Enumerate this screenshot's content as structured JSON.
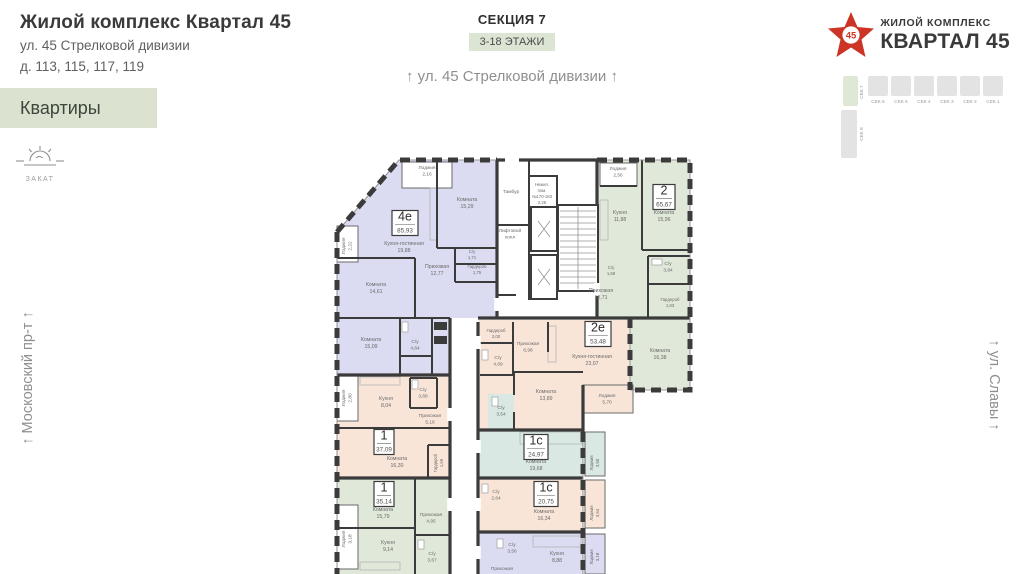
{
  "brand": {
    "title": "Жилой комплекс Квартал 45",
    "address_line1": "ул. 45 Стрелковой дивизии",
    "address_line2": "д. 113, 115, 117, 119"
  },
  "nav": {
    "flats_tab": "Квартиры"
  },
  "sunset": {
    "label": "ЗАКАТ"
  },
  "section_header": {
    "title": "СЕКЦИЯ 7",
    "floors_badge": "3-18 ЭТАЖИ",
    "street_top": "↑ ул. 45 Стрелковой дивизии ↑"
  },
  "streets": {
    "left": "↑ Московский пр-т ↑",
    "right": "↑ ул. Славы ↑"
  },
  "logo": {
    "star_number": "45",
    "line1": "ЖИЛОЙ КОМПЛЕКС",
    "line2": "КВАРТАЛ 45"
  },
  "minimap": {
    "sections_row": [
      "СЕК 6",
      "СЕК 5",
      "СЕК 4",
      "СЕК 3",
      "СЕК 2",
      "СЕК 1"
    ],
    "section_left_top": "СЕК 7",
    "section_left_bottom": "СЕК 8"
  },
  "colors": {
    "accent_green": "#dbe3d0",
    "apartment_lavender": "#dbdcf1",
    "apartment_green": "#e0e8da",
    "apartment_peach": "#f8e5d8",
    "apartment_teal": "#d9e8e3",
    "wall": "#3b3b3b",
    "logo_red": "#cc3526"
  },
  "plan": {
    "apartments": [
      {
        "type": "4е",
        "area": "85,93",
        "x": 405,
        "y": 223,
        "w": 26
      },
      {
        "type": "2",
        "area": "65,67",
        "x": 664,
        "y": 197,
        "w": 22
      },
      {
        "type": "2е",
        "area": "53,48",
        "x": 598,
        "y": 334,
        "w": 26
      },
      {
        "type": "1",
        "area": "37,09",
        "x": 384,
        "y": 442,
        "w": 20
      },
      {
        "type": "1",
        "area": "35,14",
        "x": 384,
        "y": 494,
        "w": 20
      },
      {
        "type": "1с",
        "area": "24,97",
        "x": 536,
        "y": 447,
        "w": 24
      },
      {
        "type": "1с",
        "area": "20,75",
        "x": 546,
        "y": 494,
        "w": 24
      }
    ],
    "labels": [
      {
        "lines": [
          "Лоджия",
          "2,16"
        ],
        "x": 427,
        "y": 169,
        "fs": 4.8
      },
      {
        "lines": [
          "Лоджия",
          "2,22"
        ],
        "x": 345,
        "y": 246,
        "rot": -90,
        "fs": 4.8
      },
      {
        "lines": [
          "Комната",
          "15,29"
        ],
        "x": 467,
        "y": 201
      },
      {
        "lines": [
          "Кухня-гостинная",
          "19,88"
        ],
        "x": 404,
        "y": 245
      },
      {
        "lines": [
          "Прихожая",
          "12,77"
        ],
        "x": 437,
        "y": 268
      },
      {
        "lines": [
          "С/у",
          "1,71"
        ],
        "x": 472,
        "y": 253,
        "fs": 4.3
      },
      {
        "lines": [
          "Гардероб",
          "1,75"
        ],
        "x": 477,
        "y": 268,
        "fs": 4.3
      },
      {
        "lines": [
          "Комната",
          "14,61"
        ],
        "x": 376,
        "y": 286
      },
      {
        "lines": [
          "Комната",
          "15,09"
        ],
        "x": 371,
        "y": 341
      },
      {
        "lines": [
          "С/у",
          "4,64"
        ],
        "x": 415,
        "y": 343,
        "fs": 4.8
      },
      {
        "lines": [
          "Тамбур"
        ],
        "x": 511,
        "y": 193,
        "fs": 4.8
      },
      {
        "lines": [
          "Нежил.",
          "пом.",
          "№170-183",
          "2,25"
        ],
        "x": 542,
        "y": 186,
        "fs": 4.2
      },
      {
        "lines": [
          "Лифтовой",
          "холл"
        ],
        "x": 510,
        "y": 232,
        "fs": 4.8
      },
      {
        "lines": [
          "Лоджия",
          "2,56"
        ],
        "x": 618,
        "y": 170,
        "fs": 4.8
      },
      {
        "lines": [
          "Кухня",
          "11,88"
        ],
        "x": 620,
        "y": 214
      },
      {
        "lines": [
          "Комната",
          "15,96"
        ],
        "x": 664,
        "y": 214
      },
      {
        "lines": [
          "С/у",
          "1,69"
        ],
        "x": 611,
        "y": 269,
        "fs": 4.3
      },
      {
        "lines": [
          "С/у",
          "3,84"
        ],
        "x": 668,
        "y": 265,
        "fs": 4.8
      },
      {
        "lines": [
          "Прихожая",
          "12,71"
        ],
        "x": 601,
        "y": 292
      },
      {
        "lines": [
          "Гардероб",
          "1,93"
        ],
        "x": 670,
        "y": 301,
        "fs": 4.3
      },
      {
        "lines": [
          "Комната",
          "16,38"
        ],
        "x": 660,
        "y": 352
      },
      {
        "lines": [
          "Гардероб",
          "2,00"
        ],
        "x": 496,
        "y": 332,
        "fs": 4.3
      },
      {
        "lines": [
          "Прихожая",
          "6,98"
        ],
        "x": 528,
        "y": 345,
        "fs": 4.8
      },
      {
        "lines": [
          "С/у",
          "4,69"
        ],
        "x": 498,
        "y": 359,
        "fs": 4.8
      },
      {
        "lines": [
          "Кухня-гостинная",
          "23,07"
        ],
        "x": 592,
        "y": 358
      },
      {
        "lines": [
          "Комната",
          "13,89"
        ],
        "x": 546,
        "y": 393
      },
      {
        "lines": [
          "Лоджия",
          "5,70"
        ],
        "x": 607,
        "y": 397,
        "fs": 4.8
      },
      {
        "lines": [
          "Лоджия",
          "2,80"
        ],
        "x": 345,
        "y": 398,
        "rot": -90,
        "fs": 4.8
      },
      {
        "lines": [
          "Кухня",
          "8,04"
        ],
        "x": 386,
        "y": 400
      },
      {
        "lines": [
          "С/у",
          "3,68"
        ],
        "x": 423,
        "y": 391,
        "fs": 4.8
      },
      {
        "lines": [
          "Прихожая",
          "5,18"
        ],
        "x": 430,
        "y": 417,
        "fs": 4.8
      },
      {
        "lines": [
          "Комната",
          "16,30"
        ],
        "x": 397,
        "y": 460
      },
      {
        "lines": [
          "Гардероб",
          "1,69"
        ],
        "x": 437,
        "y": 463,
        "rot": -90,
        "fs": 4.2
      },
      {
        "lines": [
          "Комната",
          "15,79"
        ],
        "x": 383,
        "y": 511
      },
      {
        "lines": [
          "Прихожая",
          "4,95"
        ],
        "x": 431,
        "y": 516,
        "fs": 4.8
      },
      {
        "lines": [
          "Лоджия",
          "3,18"
        ],
        "x": 345,
        "y": 539,
        "rot": -90,
        "fs": 4.8
      },
      {
        "lines": [
          "Кухня",
          "9,14"
        ],
        "x": 388,
        "y": 544
      },
      {
        "lines": [
          "С/у",
          "3,67"
        ],
        "x": 432,
        "y": 555,
        "fs": 4.8
      },
      {
        "lines": [
          "С/у",
          "3,54"
        ],
        "x": 501,
        "y": 409,
        "fs": 4.8
      },
      {
        "lines": [
          "Комната",
          "19,68"
        ],
        "x": 536,
        "y": 463
      },
      {
        "lines": [
          "Лоджия",
          "3,50"
        ],
        "x": 593,
        "y": 463,
        "rot": -90,
        "fs": 4.3
      },
      {
        "lines": [
          "С/у",
          "2,64"
        ],
        "x": 496,
        "y": 493,
        "fs": 4.8
      },
      {
        "lines": [
          "Комната",
          "16,34"
        ],
        "x": 544,
        "y": 513
      },
      {
        "lines": [
          "Лоджия",
          "3,54"
        ],
        "x": 593,
        "y": 513,
        "rot": -90,
        "fs": 4.3
      },
      {
        "lines": [
          "С/у",
          "3,56"
        ],
        "x": 512,
        "y": 546,
        "fs": 4.8
      },
      {
        "lines": [
          "Кухня",
          "8,88"
        ],
        "x": 557,
        "y": 555
      },
      {
        "lines": [
          "Прихожая"
        ],
        "x": 502,
        "y": 570,
        "fs": 4.8
      },
      {
        "lines": [
          "Лоджия",
          "3,18"
        ],
        "x": 593,
        "y": 557,
        "rot": -90,
        "fs": 4.3
      }
    ]
  }
}
